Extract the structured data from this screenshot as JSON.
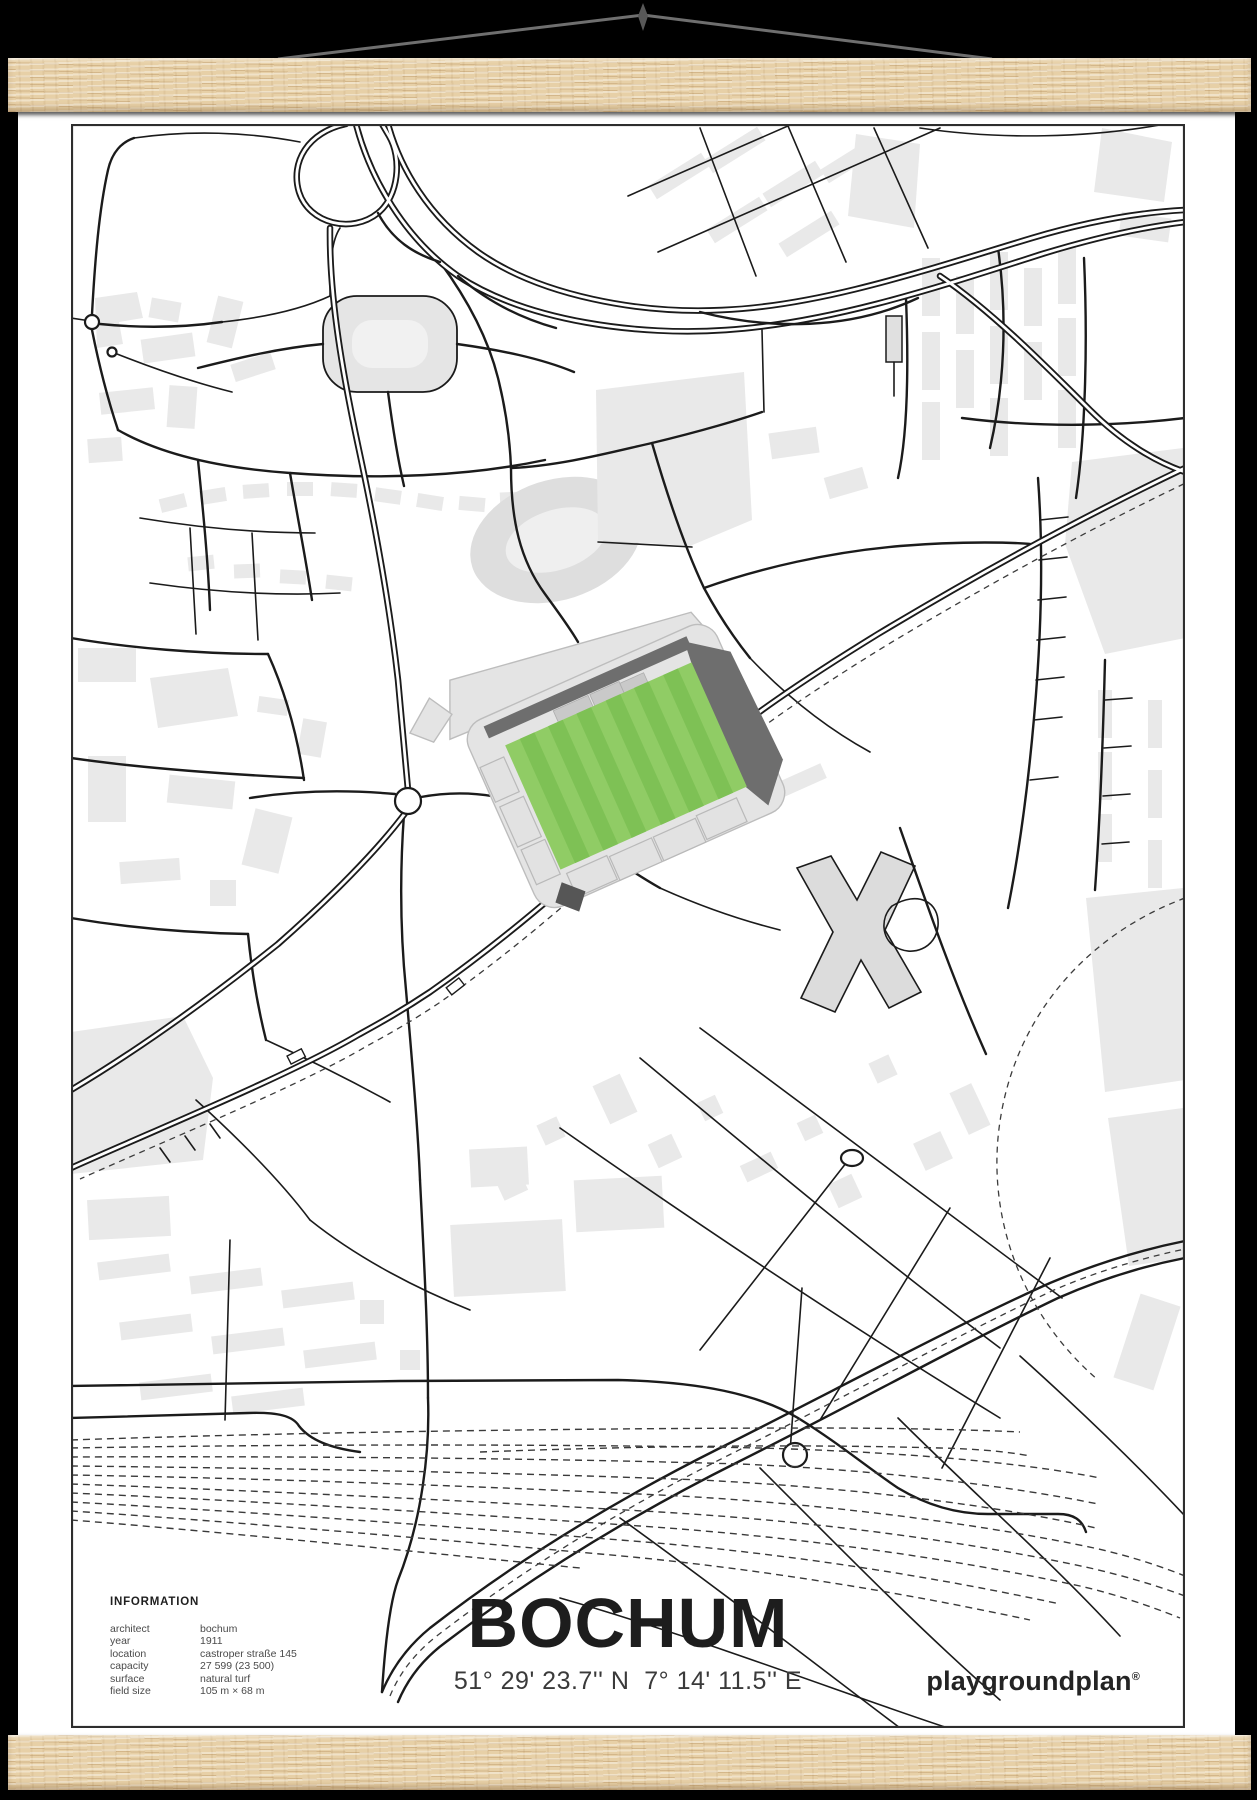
{
  "poster": {
    "title": "BOCHUM",
    "coordinates": "51° 29' 23.7'' N  7° 14' 11.5'' E",
    "brand": "playgroundplan",
    "brand_mark": "®",
    "information": {
      "heading": "INFORMATION",
      "rows": [
        {
          "label": "architect",
          "value": "bochum"
        },
        {
          "label": "year",
          "value": "1911"
        },
        {
          "label": "location",
          "value": "castroper straße 145"
        },
        {
          "label": "capacity",
          "value": "27 599 (23 500)"
        },
        {
          "label": "surface",
          "value": "natural turf"
        },
        {
          "label": "field size",
          "value": "105 m × 68 m"
        }
      ]
    },
    "map_features": {
      "stadium": "stadium footprint with striped green pitch",
      "railway": "dashed railway tracks bottom",
      "roundabout": "roundabout west of stadium"
    }
  },
  "colors": {
    "paper": "#ffffff",
    "wood": "#e7d0a7",
    "string": "#6f6f6f",
    "frame": "#2e2e2e",
    "road": "#1b1b1b",
    "building": "#e9e9e9",
    "building-dark": "#dedede",
    "stand-light": "#e4e4e4",
    "stand-mid": "#c9c9c9",
    "stand-dark": "#6e6e6e",
    "pitch-light": "#90cc65",
    "pitch-dark": "#7ec155"
  }
}
